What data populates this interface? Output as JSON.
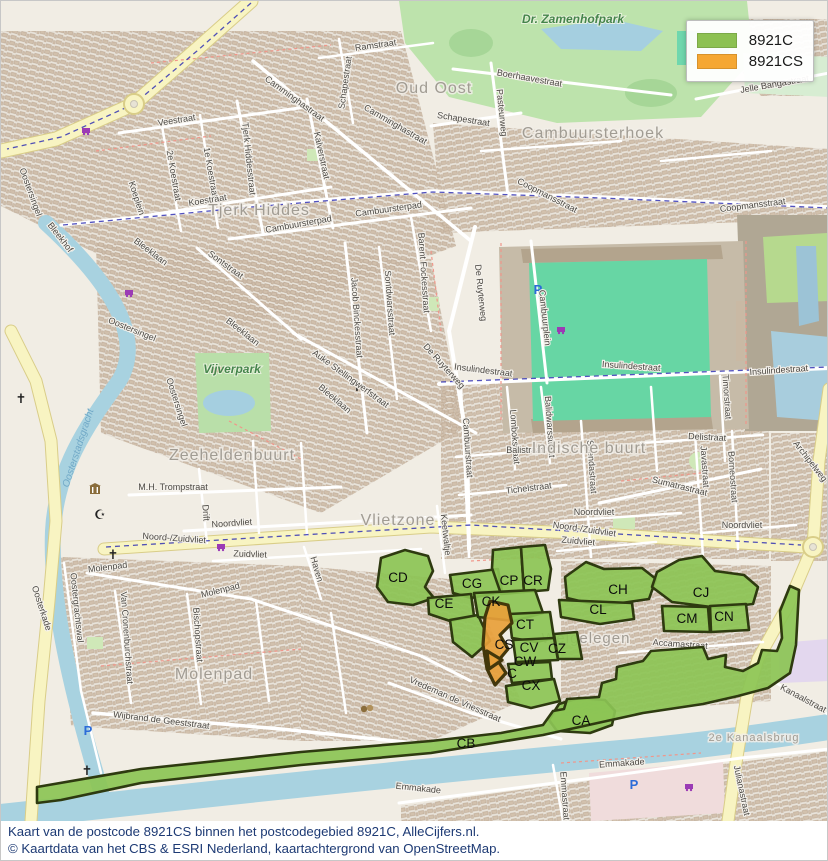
{
  "legend": {
    "items": [
      {
        "label": "8921C",
        "color": "#8cc152"
      },
      {
        "label": "8921CS",
        "color": "#f5a733"
      }
    ]
  },
  "caption": {
    "line1": "Kaart van de postcode 8921CS binnen het postcodegebied 8921C, AlleCijfers.nl.",
    "line2": "© Kaartdata van het CBS & ESRI Nederland, kaartachtergrond van OpenStreetMap."
  },
  "map": {
    "colors": {
      "region_green_fill": "#8cc455",
      "region_green_stroke": "#2e3a10",
      "region_orange_fill": "#e8a03a",
      "region_orange_stroke": "#43370b",
      "water": "#a8d2e0",
      "road_major": "#f8f4c2",
      "park": "#bde3ac",
      "pitch": "#67d6a4"
    },
    "neighborhood_labels": [
      {
        "t": "Oud Oost",
        "x": 433,
        "y": 92,
        "s": 16
      },
      {
        "t": "Cambuursterhoek",
        "x": 592,
        "y": 137,
        "s": 16
      },
      {
        "t": "Tjerk Hiddes",
        "x": 258,
        "y": 214,
        "s": 16
      },
      {
        "t": "Zeeheldenbuurt",
        "x": 231,
        "y": 459,
        "s": 16
      },
      {
        "t": "Indische buurt",
        "x": 588,
        "y": 452,
        "s": 16
      },
      {
        "t": "Vlietzone",
        "x": 397,
        "y": 524,
        "s": 16
      },
      {
        "t": "Molenpad",
        "x": 213,
        "y": 678,
        "s": 16
      },
      {
        "t": "Welgelegen",
        "x": 585,
        "y": 642,
        "s": 15
      },
      {
        "t": "2e Kanaalsbrug",
        "x": 753,
        "y": 740,
        "s": 11
      }
    ],
    "park_labels": [
      {
        "t": "Dr. Zamenhofpark",
        "x": 572,
        "y": 22
      },
      {
        "t": "Vijverpark",
        "x": 231,
        "y": 372
      }
    ],
    "water_labels": [
      {
        "t": "Oosterstadsgracht",
        "x": 80,
        "y": 448,
        "r": -72
      }
    ],
    "street_labels": [
      {
        "t": "Ramstraat",
        "x": 375,
        "y": 47,
        "r": -8
      },
      {
        "t": "Schapestraat",
        "x": 347,
        "y": 82,
        "r": -82
      },
      {
        "t": "Camminghastraat",
        "x": 292,
        "y": 100,
        "r": 36
      },
      {
        "t": "Camminghastraat",
        "x": 393,
        "y": 126,
        "r": 30
      },
      {
        "t": "Veestraat",
        "x": 176,
        "y": 122,
        "r": -9
      },
      {
        "t": "Tjerk Hiddesstraat",
        "x": 245,
        "y": 158,
        "r": 84
      },
      {
        "t": "1e Koestraat",
        "x": 207,
        "y": 172,
        "r": 80
      },
      {
        "t": "2e Koestraat",
        "x": 170,
        "y": 175,
        "r": 80
      },
      {
        "t": "Koestraat",
        "x": 207,
        "y": 202,
        "r": -9
      },
      {
        "t": "Koeplein",
        "x": 133,
        "y": 198,
        "r": 72
      },
      {
        "t": "Kalverstraat",
        "x": 318,
        "y": 155,
        "r": 78
      },
      {
        "t": "Boerhaavestraat",
        "x": 528,
        "y": 80,
        "r": 10
      },
      {
        "t": "Pasteurweg",
        "x": 498,
        "y": 112,
        "r": 84
      },
      {
        "t": "Schapestraat",
        "x": 462,
        "y": 121,
        "r": 9
      },
      {
        "t": "Jelle Bangastraat",
        "x": 774,
        "y": 86,
        "r": -10
      },
      {
        "t": "Coopmansstraat",
        "x": 545,
        "y": 197,
        "r": 27
      },
      {
        "t": "Coopmansstraat",
        "x": 752,
        "y": 207,
        "r": -7
      },
      {
        "t": "Cambuursterpad",
        "x": 298,
        "y": 226,
        "r": -10
      },
      {
        "t": "Cambuursterpad",
        "x": 388,
        "y": 211,
        "r": -8
      },
      {
        "t": "Sontstraat",
        "x": 223,
        "y": 266,
        "r": 36
      },
      {
        "t": "Bleekhof",
        "x": 57,
        "y": 238,
        "r": 52
      },
      {
        "t": "Bleeklaan",
        "x": 148,
        "y": 253,
        "r": 37
      },
      {
        "t": "Bleeklaan",
        "x": 240,
        "y": 333,
        "r": 38
      },
      {
        "t": "Bleeklaan",
        "x": 332,
        "y": 400,
        "r": 40
      },
      {
        "t": "Oostersingel",
        "x": 27,
        "y": 192,
        "r": 70
      },
      {
        "t": "Oostersingel",
        "x": 130,
        "y": 331,
        "r": 22
      },
      {
        "t": "Oostersingel",
        "x": 173,
        "y": 402,
        "r": 72
      },
      {
        "t": "Jacob Binckesstraat",
        "x": 353,
        "y": 317,
        "r": 86
      },
      {
        "t": "Sontdwarsstraat",
        "x": 386,
        "y": 302,
        "r": 86
      },
      {
        "t": "Auke Stellingwerfstraat",
        "x": 348,
        "y": 380,
        "r": 36
      },
      {
        "t": "Barent Fockesstraat",
        "x": 420,
        "y": 272,
        "r": 86
      },
      {
        "t": "De Ruyterweg",
        "x": 477,
        "y": 292,
        "r": 84
      },
      {
        "t": "De Ruyterweg",
        "x": 441,
        "y": 367,
        "r": 48
      },
      {
        "t": "Insulindestraat",
        "x": 482,
        "y": 372,
        "r": 7
      },
      {
        "t": "Insulindestraat",
        "x": 630,
        "y": 368,
        "r": 4
      },
      {
        "t": "Insulindestraat",
        "x": 778,
        "y": 372,
        "r": -4
      },
      {
        "t": "Cambuurplein",
        "x": 541,
        "y": 317,
        "r": 84
      },
      {
        "t": "Cambuurstraat",
        "x": 464,
        "y": 447,
        "r": 86
      },
      {
        "t": "Lombokstraat",
        "x": 511,
        "y": 436,
        "r": 86
      },
      {
        "t": "Balidwarsstraat",
        "x": 546,
        "y": 426,
        "r": 86
      },
      {
        "t": "Balistraat",
        "x": 524,
        "y": 452,
        "r": 0
      },
      {
        "t": "Tichelstraat",
        "x": 528,
        "y": 490,
        "r": -7
      },
      {
        "t": "Soendastraat",
        "x": 588,
        "y": 466,
        "r": 86
      },
      {
        "t": "Sumatrastraat",
        "x": 678,
        "y": 488,
        "r": 14
      },
      {
        "t": "Delistraat",
        "x": 706,
        "y": 439,
        "r": 3
      },
      {
        "t": "Javastraat",
        "x": 701,
        "y": 466,
        "r": 86
      },
      {
        "t": "Borneostraat",
        "x": 729,
        "y": 476,
        "r": 86
      },
      {
        "t": "Timorstraat",
        "x": 723,
        "y": 396,
        "r": 86
      },
      {
        "t": "Archipelweg",
        "x": 807,
        "y": 462,
        "r": 52
      },
      {
        "t": "M.H. Trompstraat",
        "x": 172,
        "y": 489,
        "r": 0
      },
      {
        "t": "Drift",
        "x": 202,
        "y": 512,
        "r": 86
      },
      {
        "t": "Noordvliet",
        "x": 231,
        "y": 525,
        "r": -4
      },
      {
        "t": "Noordvliet",
        "x": 593,
        "y": 514,
        "r": 0
      },
      {
        "t": "Noordvliet",
        "x": 741,
        "y": 527,
        "r": 0
      },
      {
        "t": "Noord-/Zuidvliet",
        "x": 173,
        "y": 540,
        "r": 4
      },
      {
        "t": "Noord-/Zuidvliet",
        "x": 583,
        "y": 531,
        "r": 8
      },
      {
        "t": "Zuidvliet",
        "x": 249,
        "y": 556,
        "r": 2
      },
      {
        "t": "Zuidvliet",
        "x": 577,
        "y": 543,
        "r": 5
      },
      {
        "t": "Keetwaltje",
        "x": 442,
        "y": 534,
        "r": 84
      },
      {
        "t": "Haven",
        "x": 313,
        "y": 569,
        "r": 74
      },
      {
        "t": "Molenpad",
        "x": 107,
        "y": 569,
        "r": -7
      },
      {
        "t": "Molenpad",
        "x": 220,
        "y": 592,
        "r": -14
      },
      {
        "t": "Oosterkade",
        "x": 38,
        "y": 608,
        "r": 72
      },
      {
        "t": "Oostergrachtswal",
        "x": 73,
        "y": 607,
        "r": 84
      },
      {
        "t": "Van Cronenburchstraat",
        "x": 123,
        "y": 637,
        "r": 86
      },
      {
        "t": "Bischopstraat",
        "x": 194,
        "y": 634,
        "r": 86
      },
      {
        "t": "Wijbrand de Geeststraat",
        "x": 160,
        "y": 722,
        "r": 7
      },
      {
        "t": "Vredeman de Vriesstraat",
        "x": 453,
        "y": 701,
        "r": 24
      },
      {
        "t": "Accamastraat",
        "x": 679,
        "y": 646,
        "r": 4
      },
      {
        "t": "Emmakade",
        "x": 621,
        "y": 765,
        "r": -4
      },
      {
        "t": "Emmakade",
        "x": 417,
        "y": 790,
        "r": 6
      },
      {
        "t": "Emmastraat",
        "x": 561,
        "y": 795,
        "r": 86
      },
      {
        "t": "Julianastraat",
        "x": 738,
        "y": 790,
        "r": 78
      },
      {
        "t": "Kanaalstraat",
        "x": 801,
        "y": 700,
        "r": 28
      }
    ],
    "regions": [
      {
        "code": "CD",
        "fill": "green",
        "pts": "380,557 404,549 427,555 432,570 424,586 433,597 412,604 387,601 376,586",
        "lx": 397,
        "ly": 581
      },
      {
        "code": "CG",
        "fill": "green",
        "pts": "449,574 497,568 501,591 470,597 452,592",
        "lx": 471,
        "ly": 587
      },
      {
        "code": "CP",
        "fill": "green",
        "pts": "492,549 520,546 523,591 500,593 491,567",
        "lx": 508,
        "ly": 584
      },
      {
        "code": "CR",
        "fill": "green",
        "pts": "520,546 544,544 550,568 547,589 523,591",
        "lx": 532,
        "ly": 584
      },
      {
        "code": "CE",
        "fill": "green",
        "pts": "427,597 470,593 473,615 449,620 428,613",
        "lx": 443,
        "ly": 607
      },
      {
        "code": "CE2",
        "fill": "green",
        "pts": "449,619 477,614 489,640 471,656 452,641",
        "lx": 0,
        "ly": 0
      },
      {
        "code": "CK",
        "fill": "green",
        "pts": "473,592 534,589 542,612 513,620 477,616",
        "lx": 490,
        "ly": 605
      },
      {
        "code": "CH",
        "fill": "green",
        "pts": "564,576 585,561 603,568 641,567 655,578 648,598 600,605 566,597",
        "lx": 617,
        "ly": 593
      },
      {
        "code": "CJ",
        "fill": "green",
        "pts": "656,571 678,559 701,555 714,570 743,574 757,586 752,603 718,607 671,601 651,586",
        "lx": 700,
        "ly": 596
      },
      {
        "code": "CL",
        "fill": "green",
        "pts": "558,599 631,602 633,618 599,623 560,616",
        "lx": 597,
        "ly": 613
      },
      {
        "code": "CM",
        "fill": "green",
        "pts": "661,605 707,606 709,631 663,630",
        "lx": 686,
        "ly": 622
      },
      {
        "code": "CN",
        "fill": "green",
        "pts": "709,605 745,603 748,629 710,631",
        "lx": 723,
        "ly": 620
      },
      {
        "code": "CT",
        "fill": "green",
        "pts": "508,613 549,611 553,637 535,641 511,637",
        "lx": 524,
        "ly": 628
      },
      {
        "code": "CV",
        "fill": "green",
        "pts": "512,639 553,637 557,659 515,661",
        "lx": 528,
        "ly": 651
      },
      {
        "code": "CZ",
        "fill": "green",
        "pts": "553,633 576,631 581,658 557,658",
        "lx": 556,
        "ly": 652
      },
      {
        "code": "CW",
        "fill": "green",
        "pts": "507,663 549,661 551,678 511,682",
        "lx": 524,
        "ly": 665
      },
      {
        "code": "CX",
        "fill": "green",
        "pts": "505,685 553,678 559,700 530,707 507,701",
        "lx": 530,
        "ly": 689
      },
      {
        "code": "CA",
        "fill": "green",
        "pts": "548,719 558,703 578,697 604,699 614,710 611,724 589,732 556,730",
        "lx": 580,
        "ly": 724
      },
      {
        "code": "CB",
        "fill": "green",
        "pts": "36,786 140,768 300,751 430,740 500,732 542,724 552,710 563,708 566,698 598,696 601,682 615,678 616,666 642,660 650,650 702,646 707,658 725,654 724,666 742,670 757,662 761,649 776,650 781,637 779,610 789,585 798,589 795,644 789,672 767,687 737,695 702,703 642,712 542,734 430,752 300,764 140,782 60,799 36,802",
        "lx": 465,
        "ly": 747
      },
      {
        "code": "CS",
        "fill": "orange",
        "pts": "489,600 507,604 511,622 499,634 507,648 497,660 505,672 494,684 486,668 482,644 484,616",
        "lx": 503,
        "ly": 648
      },
      {
        "code": "C",
        "fill": "orange",
        "pts": "486,650 501,659 488,668",
        "lx": 511,
        "ly": 677
      }
    ],
    "pois": [
      {
        "type": "church",
        "x": 20,
        "y": 402
      },
      {
        "type": "church",
        "x": 356,
        "y": 390
      },
      {
        "type": "church",
        "x": 112,
        "y": 558
      },
      {
        "type": "church",
        "x": 86,
        "y": 774
      },
      {
        "type": "mosque",
        "x": 99,
        "y": 518
      },
      {
        "type": "museum",
        "x": 94,
        "y": 492
      },
      {
        "type": "theater",
        "x": 216,
        "y": 370
      },
      {
        "type": "theater",
        "x": 366,
        "y": 708
      },
      {
        "type": "supermarket",
        "x": 85,
        "y": 133
      },
      {
        "type": "supermarket",
        "x": 128,
        "y": 295
      },
      {
        "type": "supermarket",
        "x": 560,
        "y": 332
      },
      {
        "type": "supermarket",
        "x": 220,
        "y": 549
      },
      {
        "type": "supermarket",
        "x": 688,
        "y": 789
      },
      {
        "type": "parking",
        "x": 87,
        "y": 734
      },
      {
        "type": "parking",
        "x": 537,
        "y": 293
      },
      {
        "type": "parking",
        "x": 633,
        "y": 788
      }
    ]
  }
}
